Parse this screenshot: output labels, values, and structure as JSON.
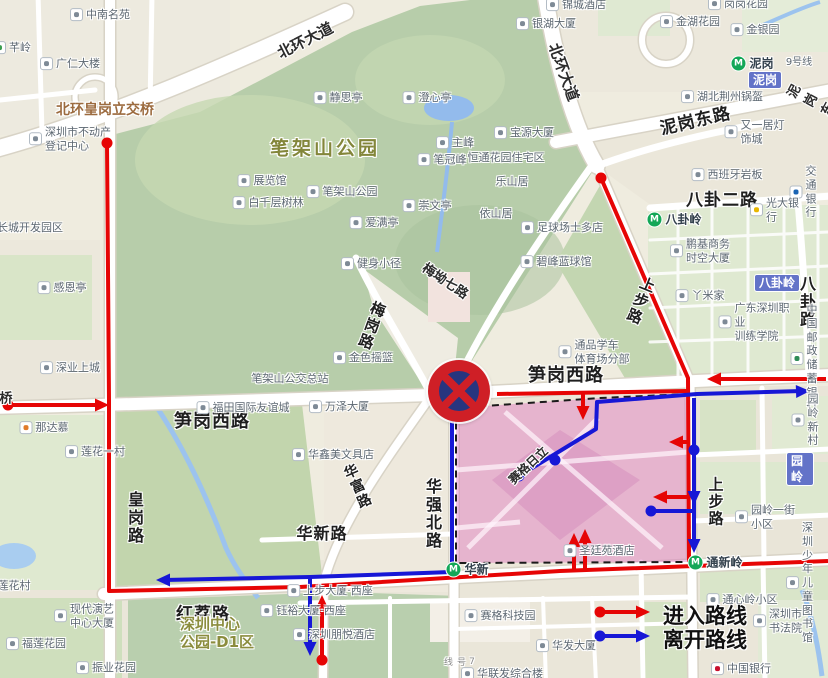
{
  "legend": {
    "enter": "进入路线",
    "leave": "离开路线"
  },
  "colors": {
    "enter": "#e60505",
    "leave": "#1717d6"
  },
  "sign": {
    "x": 459,
    "y": 391
  },
  "zone": {
    "points": "456,408 600,398 688,394 690,562 456,563",
    "fill": "#de62be",
    "fill_opacity": 0.38,
    "border": "#1a1a1a",
    "patch": "560,430 640,480 560,540 492,480",
    "inner": [
      [
        [
          468,
          548
        ],
        [
          598,
          418
        ]
      ],
      [
        [
          505,
          412
        ],
        [
          662,
          548
        ]
      ],
      [
        [
          456,
          470
        ],
        [
          688,
          452
        ]
      ],
      [
        [
          456,
          528
        ],
        [
          520,
          522
        ]
      ]
    ]
  },
  "routes": [
    {
      "color": "enter",
      "pts": [
        [
          8,
          405
        ],
        [
          104,
          405
        ]
      ],
      "dots": [
        [
          8,
          405
        ]
      ],
      "arrows": [
        [
          109,
          405,
          0
        ]
      ]
    },
    {
      "color": "enter",
      "pts": [
        [
          107,
          143
        ],
        [
          109,
          400
        ],
        [
          109,
          591
        ],
        [
          300,
          587
        ],
        [
          560,
          571
        ],
        [
          828,
          561
        ]
      ],
      "dots": [
        [
          107,
          143
        ]
      ],
      "arrows": []
    },
    {
      "color": "enter",
      "pts": [
        [
          601,
          178
        ],
        [
          688,
          378
        ],
        [
          689,
          562
        ]
      ],
      "dots": [
        [
          601,
          178
        ]
      ],
      "arrows": []
    },
    {
      "color": "enter",
      "pts": [
        [
          826,
          379
        ],
        [
          713,
          379
        ]
      ],
      "dots": [],
      "arrows": [
        [
          707,
          379,
          180
        ]
      ]
    },
    {
      "color": "enter",
      "pts": [
        [
          497,
          394
        ],
        [
          688,
          391
        ]
      ],
      "dots": [],
      "arrows": []
    },
    {
      "color": "enter",
      "pts": [
        [
          583,
          393
        ],
        [
          583,
          414
        ]
      ],
      "dots": [],
      "arrows": [
        [
          583,
          420,
          90
        ]
      ]
    },
    {
      "color": "enter",
      "pts": [
        [
          322,
          660
        ],
        [
          322,
          601
        ]
      ],
      "dots": [
        [
          322,
          660
        ]
      ],
      "arrows": [
        [
          322,
          595,
          -90
        ]
      ]
    },
    {
      "color": "enter",
      "pts": [
        [
          574,
          569
        ],
        [
          574,
          540
        ]
      ],
      "dots": [],
      "arrows": [
        [
          574,
          533,
          -90
        ]
      ]
    },
    {
      "color": "enter",
      "pts": [
        [
          585,
          569
        ],
        [
          585,
          536
        ]
      ],
      "dots": [],
      "arrows": [
        [
          585,
          529,
          -90
        ]
      ]
    },
    {
      "color": "enter",
      "pts": [
        [
          689,
          442
        ],
        [
          675,
          442
        ]
      ],
      "dots": [],
      "arrows": [
        [
          669,
          442,
          180
        ]
      ]
    },
    {
      "color": "enter",
      "pts": [
        [
          689,
          497
        ],
        [
          659,
          497
        ]
      ],
      "dots": [],
      "arrows": [
        [
          653,
          497,
          180
        ]
      ]
    },
    {
      "color": "enter",
      "pts": [
        [
          600,
          612
        ],
        [
          641,
          612
        ]
      ],
      "dots": [
        [
          600,
          612
        ]
      ],
      "arrows": [
        [
          650,
          612,
          0
        ]
      ]
    },
    {
      "color": "leave",
      "pts": [
        [
          519,
          476
        ],
        [
          596,
          429
        ],
        [
          597,
          402
        ],
        [
          697,
          394
        ],
        [
          802,
          391
        ]
      ],
      "dots": [
        [
          519,
          476
        ],
        [
          555,
          460
        ]
      ],
      "arrows": [
        [
          810,
          391,
          -2
        ]
      ]
    },
    {
      "color": "leave",
      "pts": [
        [
          694,
          398
        ],
        [
          694,
          547
        ]
      ],
      "dots": [
        [
          694,
          450
        ]
      ],
      "arrows": [
        [
          694,
          505,
          90
        ],
        [
          694,
          553,
          90
        ]
      ]
    },
    {
      "color": "leave",
      "pts": [
        [
          651,
          511
        ],
        [
          694,
          511
        ]
      ],
      "dots": [
        [
          651,
          511
        ]
      ],
      "arrows": []
    },
    {
      "color": "leave",
      "pts": [
        [
          452,
          406
        ],
        [
          452,
          572
        ],
        [
          310,
          577
        ],
        [
          164,
          580
        ]
      ],
      "dots": [],
      "arrows": [
        [
          156,
          580,
          180
        ]
      ]
    },
    {
      "color": "leave",
      "pts": [
        [
          310,
          577
        ],
        [
          310,
          650
        ]
      ],
      "dots": [],
      "arrows": [
        [
          310,
          656,
          90
        ]
      ]
    },
    {
      "color": "leave",
      "pts": [
        [
          600,
          636
        ],
        [
          641,
          636
        ]
      ],
      "dots": [
        [
          600,
          636
        ]
      ],
      "arrows": [
        [
          650,
          636,
          0
        ]
      ]
    }
  ],
  "labels": [
    {
      "x": 100,
      "y": 15,
      "t": "中南名苑",
      "c": "poi",
      "i": 1
    },
    {
      "x": 12,
      "y": 48,
      "t": "芊岭",
      "c": "poi",
      "i": 1,
      "ic": "#3a9d4e"
    },
    {
      "x": 70,
      "y": 64,
      "t": "广仁大楼",
      "c": "poi",
      "i": 1
    },
    {
      "x": 105,
      "y": 109,
      "t": "北环皇岗立交桥",
      "c": "brown"
    },
    {
      "x": 70,
      "y": 139,
      "t": "深圳市不动产\n登记中心",
      "c": "poi",
      "i": 1
    },
    {
      "x": 30,
      "y": 228,
      "t": "长城开发园区",
      "c": "poi2"
    },
    {
      "x": 325,
      "y": 147,
      "t": "笔架山公园",
      "c": "parkb"
    },
    {
      "x": 338,
      "y": 98,
      "t": "静思亭",
      "c": "poi",
      "i": 1
    },
    {
      "x": 427,
      "y": 98,
      "t": "澄心亭",
      "c": "poi",
      "i": 1
    },
    {
      "x": 455,
      "y": 143,
      "t": "主峰",
      "c": "poi",
      "i": 1
    },
    {
      "x": 442,
      "y": 160,
      "t": "笔冠峰",
      "c": "poi",
      "i": 1
    },
    {
      "x": 524,
      "y": 133,
      "t": "宝源大厦",
      "c": "poi",
      "i": 1
    },
    {
      "x": 506,
      "y": 158,
      "t": "恒通花园住宅区",
      "c": "poi2"
    },
    {
      "x": 512,
      "y": 182,
      "t": "乐山居",
      "c": "poi2"
    },
    {
      "x": 496,
      "y": 214,
      "t": "依山居",
      "c": "poi2"
    },
    {
      "x": 262,
      "y": 181,
      "t": "展览馆",
      "c": "poi",
      "i": 1
    },
    {
      "x": 268,
      "y": 203,
      "t": "白千层树林",
      "c": "poi",
      "i": 1
    },
    {
      "x": 342,
      "y": 192,
      "t": "笔架山公园",
      "c": "poi",
      "i": 1
    },
    {
      "x": 427,
      "y": 206,
      "t": "崇文亭",
      "c": "poi",
      "i": 1
    },
    {
      "x": 374,
      "y": 223,
      "t": "爱满亭",
      "c": "poi",
      "i": 1
    },
    {
      "x": 371,
      "y": 264,
      "t": "健身小径",
      "c": "poi",
      "i": 1
    },
    {
      "x": 62,
      "y": 288,
      "t": "感恩亭",
      "c": "poi",
      "i": 1
    },
    {
      "x": 305,
      "y": 40,
      "t": "北环大道",
      "c": "rd",
      "s": 15,
      "r": -27
    },
    {
      "x": 564,
      "y": 72,
      "t": "北环大道",
      "c": "rd",
      "s": 15,
      "r": 70
    },
    {
      "x": 695,
      "y": 119,
      "t": "泥岗东路",
      "c": "rdb",
      "r": -13
    },
    {
      "x": 818,
      "y": 104,
      "t": "泥岗东路",
      "c": "rd",
      "s": 13,
      "r": -62
    },
    {
      "x": 576,
      "y": 5,
      "t": "锦城酒店",
      "c": "poi",
      "i": 1
    },
    {
      "x": 738,
      "y": 4,
      "t": "岗岗花园",
      "c": "poi",
      "i": 1
    },
    {
      "x": 546,
      "y": 24,
      "t": "银湖大厦",
      "c": "poi",
      "i": 1
    },
    {
      "x": 690,
      "y": 22,
      "t": "金湖花园",
      "c": "poi",
      "i": 1
    },
    {
      "x": 755,
      "y": 30,
      "t": "金银园",
      "c": "poi",
      "i": 1
    },
    {
      "x": 752,
      "y": 63,
      "t": "泥岗",
      "c": "metro"
    },
    {
      "x": 765,
      "y": 80,
      "t": "泥岗",
      "c": "badge"
    },
    {
      "x": 799,
      "y": 63,
      "t": "9号线",
      "c": "poi2",
      "s": 10
    },
    {
      "x": 722,
      "y": 97,
      "t": "湖北荆州锅盔",
      "c": "poi",
      "i": 1
    },
    {
      "x": 759,
      "y": 132,
      "t": "又一居灯饰城",
      "c": "poi",
      "i": 1
    },
    {
      "x": 727,
      "y": 175,
      "t": "西班牙岩板",
      "c": "poi",
      "i": 1
    },
    {
      "x": 722,
      "y": 198,
      "t": "八卦二路",
      "c": "rdb"
    },
    {
      "x": 803,
      "y": 192,
      "t": "交通银行",
      "c": "poi",
      "i": 1,
      "ic": "#1b64b4"
    },
    {
      "x": 776,
      "y": 210,
      "t": "光大银行",
      "c": "poi",
      "i": 1,
      "ic": "#e8b701"
    },
    {
      "x": 674,
      "y": 219,
      "t": "八卦岭",
      "c": "metro"
    },
    {
      "x": 700,
      "y": 251,
      "t": "鹏基商务\n时空大厦",
      "c": "poi",
      "i": 1
    },
    {
      "x": 777,
      "y": 283,
      "t": "八卦岭",
      "c": "badge"
    },
    {
      "x": 700,
      "y": 296,
      "t": "丫米家",
      "c": "poi",
      "i": 1
    },
    {
      "x": 806,
      "y": 302,
      "t": "八卦路",
      "c": "rdv",
      "s": 16
    },
    {
      "x": 755,
      "y": 322,
      "t": "广东深圳职业\n训练学院",
      "c": "poi",
      "i": 1
    },
    {
      "x": 804,
      "y": 358,
      "t": "中国邮政\n储蓄银行",
      "c": "poi",
      "i": 1,
      "ic": "#2e8b57"
    },
    {
      "x": 641,
      "y": 301,
      "t": "上步路",
      "c": "rdv",
      "r": 22
    },
    {
      "x": 716,
      "y": 502,
      "t": "上步路",
      "c": "rdv"
    },
    {
      "x": 446,
      "y": 280,
      "t": "梅坳七路",
      "c": "rd",
      "s": 13,
      "r": 34
    },
    {
      "x": 372,
      "y": 326,
      "t": "梅岗路",
      "c": "rdv",
      "r": 20
    },
    {
      "x": 363,
      "y": 358,
      "t": "金色摇篮",
      "c": "poi",
      "i": 1
    },
    {
      "x": 290,
      "y": 379,
      "t": "笔架山公交总站",
      "c": "poi2"
    },
    {
      "x": 562,
      "y": 228,
      "t": "足球场士多店",
      "c": "poi",
      "i": 1
    },
    {
      "x": 556,
      "y": 262,
      "t": "碧峰蓝球馆",
      "c": "poi",
      "i": 1
    },
    {
      "x": 594,
      "y": 352,
      "t": "通品学车\n体育场分部",
      "c": "poi",
      "i": 1
    },
    {
      "x": 212,
      "y": 420,
      "t": "笋岗西路",
      "c": "rdb",
      "s": 18
    },
    {
      "x": 566,
      "y": 374,
      "t": "笋岗西路",
      "c": "rdb",
      "s": 18
    },
    {
      "x": 243,
      "y": 408,
      "t": "福田国际友谊城",
      "c": "poi",
      "i": 1
    },
    {
      "x": 339,
      "y": 407,
      "t": "万泽大厦",
      "c": "poi",
      "i": 1
    },
    {
      "x": 70,
      "y": 368,
      "t": "深业上城",
      "c": "poi",
      "i": 1
    },
    {
      "x": 44,
      "y": 428,
      "t": "那达慕",
      "c": "poi",
      "i": 1,
      "ic": "#e07b2a"
    },
    {
      "x": 95,
      "y": 452,
      "t": "莲花一村",
      "c": "poi",
      "i": 1
    },
    {
      "x": 134,
      "y": 518,
      "t": "皇岗路",
      "c": "rdv",
      "s": 16
    },
    {
      "x": 333,
      "y": 455,
      "t": "华鑫美文具店",
      "c": "poi",
      "i": 1
    },
    {
      "x": 357,
      "y": 487,
      "t": "华富路",
      "c": "rdv",
      "s": 14,
      "r": -24
    },
    {
      "x": 322,
      "y": 532,
      "t": "华新路",
      "c": "rdb",
      "s": 16
    },
    {
      "x": 432,
      "y": 514,
      "t": "华强北路",
      "c": "rdv",
      "s": 16
    },
    {
      "x": 528,
      "y": 465,
      "t": "赛格日立",
      "c": "rd",
      "s": 12,
      "r": -43
    },
    {
      "x": 599,
      "y": 551,
      "t": "圣廷苑酒店",
      "c": "poi",
      "i": 1
    },
    {
      "x": 467,
      "y": 569,
      "t": "华新",
      "c": "metro"
    },
    {
      "x": 14,
      "y": 586,
      "t": "莲花村",
      "c": "poi2"
    },
    {
      "x": 84,
      "y": 616,
      "t": "现代演艺\n中心大厦",
      "c": "poi",
      "i": 1
    },
    {
      "x": 36,
      "y": 644,
      "t": "福莲花园",
      "c": "poi",
      "i": 1
    },
    {
      "x": 106,
      "y": 668,
      "t": "振业花园",
      "c": "poi",
      "i": 1
    },
    {
      "x": 203,
      "y": 612,
      "t": "红荔路",
      "c": "rdb"
    },
    {
      "x": 217,
      "y": 633,
      "t": "深圳中心\n公园-D1区",
      "c": "park"
    },
    {
      "x": 330,
      "y": 591,
      "t": "上步大厦·西座",
      "c": "poi",
      "i": 1
    },
    {
      "x": 303,
      "y": 611,
      "t": "钰裕大厦·西座",
      "c": "poi",
      "i": 1
    },
    {
      "x": 334,
      "y": 635,
      "t": "深圳朋悦酒店",
      "c": "poi",
      "i": 1
    },
    {
      "x": 500,
      "y": 616,
      "t": "赛格科技园",
      "c": "poi",
      "i": 1
    },
    {
      "x": 566,
      "y": 646,
      "t": "华发大厦",
      "c": "poi",
      "i": 1
    },
    {
      "x": 502,
      "y": 674,
      "t": "华联发综合楼",
      "c": "poi",
      "i": 1
    },
    {
      "x": 459,
      "y": 664,
      "t": "7号线",
      "c": "tiny"
    },
    {
      "x": 741,
      "y": 669,
      "t": "中国银行",
      "c": "poi",
      "i": 1,
      "ic": "#c8102e"
    },
    {
      "x": 715,
      "y": 562,
      "t": "通新岭",
      "c": "metro"
    },
    {
      "x": 805,
      "y": 420,
      "t": "园岭新村",
      "c": "poi",
      "i": 1
    },
    {
      "x": 800,
      "y": 469,
      "t": "园岭",
      "c": "badge"
    },
    {
      "x": 766,
      "y": 517,
      "t": "园岭一街小区",
      "c": "poi",
      "i": 1
    },
    {
      "x": 800,
      "y": 583,
      "t": "深圳少年\n儿童图书馆",
      "c": "poi",
      "i": 1
    },
    {
      "x": 742,
      "y": 600,
      "t": "通心岭小区",
      "c": "poi",
      "i": 1
    },
    {
      "x": 778,
      "y": 621,
      "t": "深圳市书法院",
      "c": "poi",
      "i": 1
    },
    {
      "x": 6,
      "y": 397,
      "t": "桥",
      "c": "rd",
      "s": 13
    }
  ]
}
